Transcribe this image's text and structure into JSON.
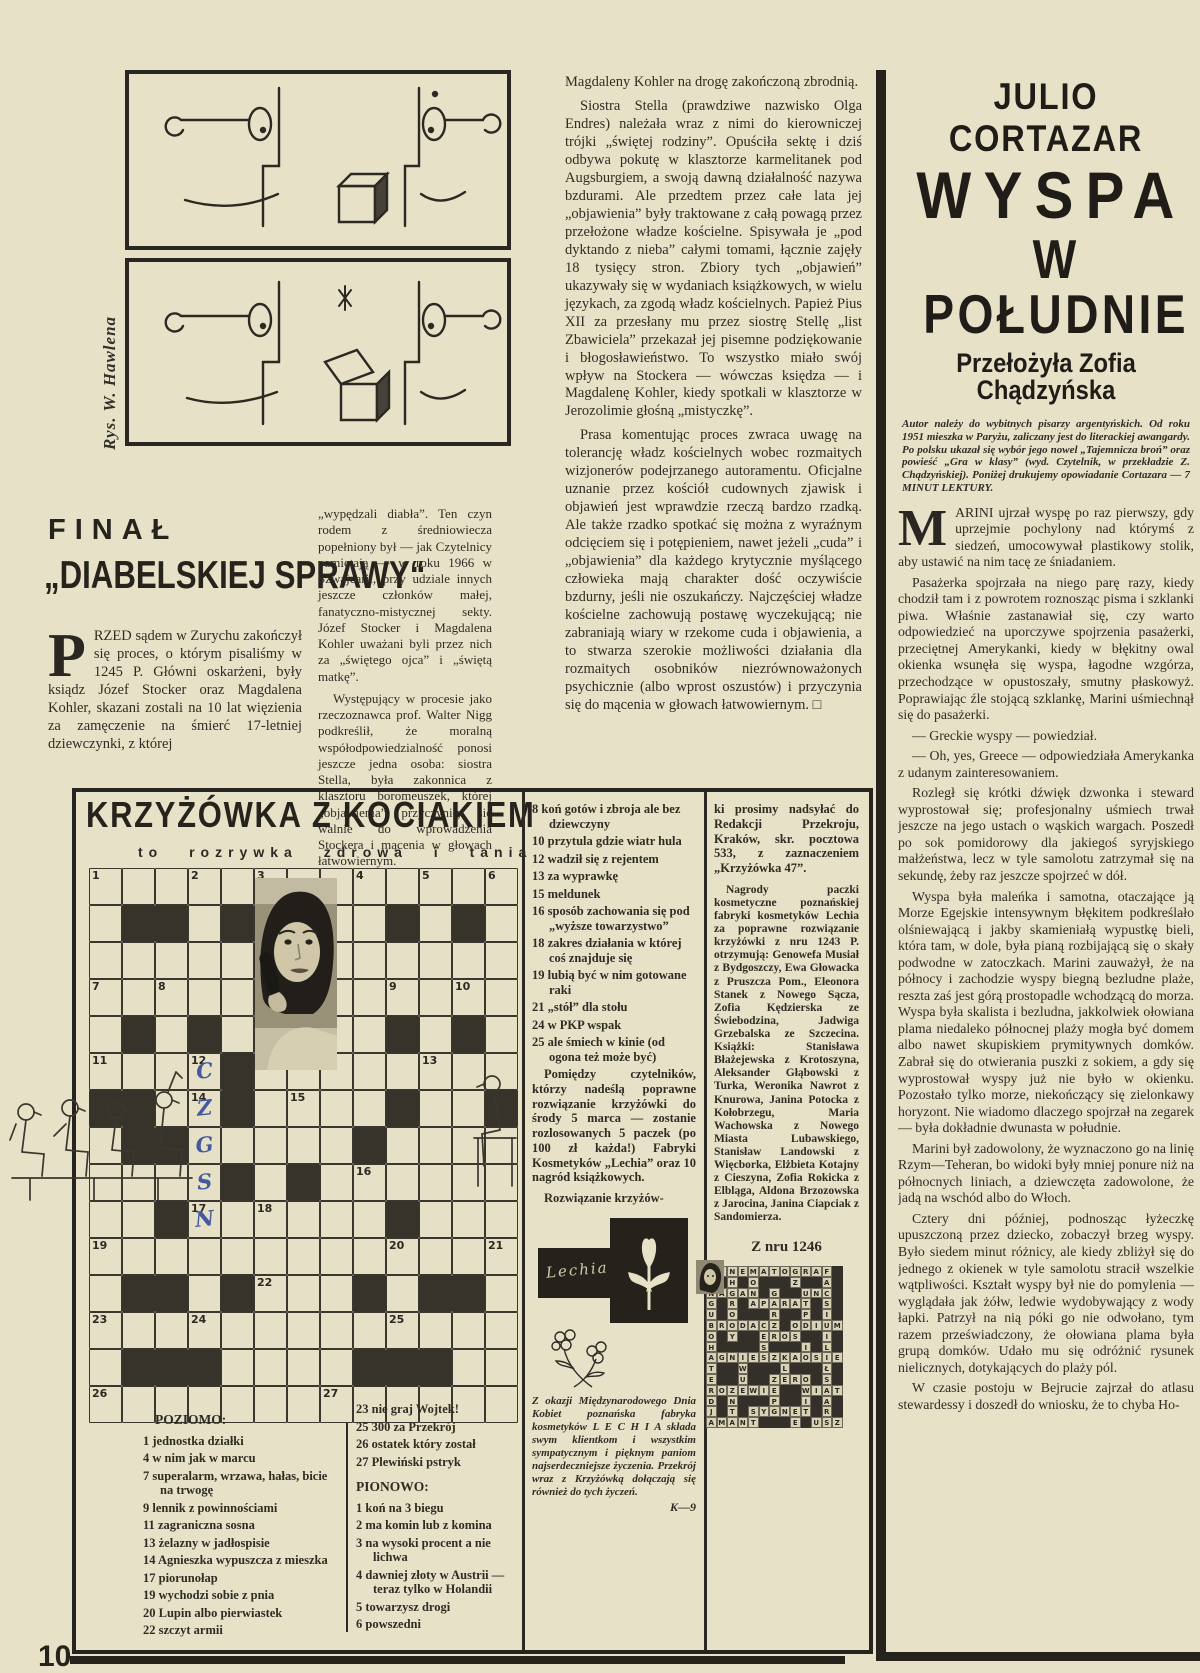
{
  "page": {
    "number": "10"
  },
  "cartoon": {
    "credit": "Rys. W. Hawlena"
  },
  "midcol": {
    "paragraphs": [
      "Magdaleny Kohler na drogę zakończoną zbrodnią.",
      "Siostra Stella (prawdziwe nazwisko Olga Endres) należała wraz z nimi do kierowniczej trójki „świętej rodziny”. Opuściła sektę i dziś odbywa pokutę w klasztorze karmelitanek pod Augsburgiem, a swoją dawną działalność nazywa bzdurami. Ale przedtem przez całe lata jej „objawienia” były traktowane z całą powagą przez przełożone władze kościelne. Spisywała je „pod dyktando z nieba” całymi tomami, łącznie zajęły 18 tysięcy stron. Zbiory tych „objawień” ukazywały się w wydaniach książkowych, w wielu językach, za zgodą władz kościelnych. Papież Pius XII za przesłany mu przez siostrę Stellę „list Zbawiciela” przekazał jej pisemne podziękowanie i błogosławieństwo. To wszystko miało swój wpływ na Stockera — wówczas księdza — i Magdalenę Kohler, kiedy spotkali w klasztorze w Jerozolimie głośną „mistyczkę”.",
      "Prasa komentując proces zwraca uwagę na tolerancję władz kościelnych wobec rozmaitych wizjonerów podejrzanego autoramentu. Oficjalne uznanie przez kościół cudownych zjawisk i objawień jest wprawdzie rzeczą bardzo rzadką. Ale także rzadko spotkać się można z wyraźnym odcięciem się i potępieniem, nawet jeżeli „cuda” i „objawienia” dla każdego krytycznie myślącego człowieka mają charakter dość oczywiście bzdurny, jeśli nie oszukańczy. Najczęściej władze kościelne zachowują postawę wyczekującą; nie zabraniają wiary w rzekome cuda i objawienia, a to stwarza szerokie możliwości działania dla rozmaitych osobników niezrównoważonych psychicznie (albo wprost oszustów) i przyczynia się do mącenia w głowach łatwowiernym. □"
    ]
  },
  "finale": {
    "kicker": "FINAŁ",
    "title": "„DIABELSKIEJ SPRAWY“",
    "dropcap": "P",
    "col1_rest": "RZED sądem w Zurychu zakończył się proces, o którym pisaliśmy w 1245 P. Główni oskarżeni, były ksiądz Józef Stocker oraz Magdalena Kohler, skazani zostali na 10 lat więzienia za zamęczenie na śmierć 17-letniej dziewczynki, z której",
    "col2_paragraphs": [
      "„wypędzali diabła”. Ten czyn rodem z średniowiecza popełniony był — jak Czytelnicy pamiętają — w roku 1966 w Szwajcarii, przy udziale innych jeszcze członków małej, fanatyczno-mistycznej sekty. Józef Stocker i Magdalena Kohler uważani byli przez nich za „świętego ojca” i „świętą matkę”.",
      "Występujący w procesie jako rzeczoznawca prof. Walter Nigg podkreślił, że moralną współodpowiedzialność ponosi jeszcze jedna osoba: siostra Stella, była zakonnica z klasztoru boromeuszek, której „objawienia” przyczyniły się walnie do wprowadzenia Stockera i mącenia w głowach łatwowiernym."
    ]
  },
  "cortazar": {
    "author": "JULIO CORTAZAR",
    "title_line1": "WYSPA",
    "title_line2": "W POŁUDNIE",
    "translator": "Przełożyła Zofia Chądzyńska",
    "intro": "Autor należy do wybitnych pisarzy argentyńskich. Od roku 1951 mieszka w Paryżu, zaliczany jest do literackiej awangardy. Po polsku ukazał się wybór jego nowel „Tajemnicza broń” oraz powieść „Gra w klasy” (wyd. Czytelnik, w przekładzie Z. Chądzyńskiej). Poniżej drukujemy opowiadanie Cortazara — 7 MINUT LEKTURY.",
    "dropcap": "M",
    "first_paragraph": "ARINI ujrzał wyspę po raz pierwszy, gdy uprzejmie pochylony nad którymś z siedzeń, umocowywał plastikowy stolik, aby ustawić na nim tacę ze śniadaniem.",
    "paragraphs": [
      "Pasażerka spojrzała na niego parę razy, kiedy chodził tam i z powrotem roznosząc pisma i szklanki piwa. Właśnie zastanawiał się, czy warto odpowiedzieć na uporczywe spojrzenia pasażerki, przeciętnej Amerykanki, kiedy w błękitny owal okienka wsunęła się wyspa, łagodne wzgórza, przechodzące w opustoszały, smutny płaskowyż. Poprawiając źle stojącą szklankę, Marini uśmiechnął się do pasażerki.",
      "— Greckie wyspy — powiedział.",
      "— Oh, yes, Greece — odpowiedziała Amerykanka z udanym zainteresowaniem.",
      "Rozległ się krótki dźwięk dzwonka i steward wyprostował się; profesjonalny uśmiech trwał jeszcze na jego ustach o wąskich wargach. Poszedł po sok pomidorowy dla jakiegoś syryjskiego małżeństwa, lecz w tyle samolotu zatrzymał się na sekundę, żeby raz jeszcze spojrzeć w dół.",
      "Wyspa była maleńka i samotna, otaczające ją Morze Egejskie intensywnym błękitem podkreślało olśniewającą i jakby skamieniałą wypustkę bieli, która tam, w dole, była pianą rozbijającą się o skały podwodne w zatoczkach. Marini zauważył, że na północy i zachodzie wyspy biegną bezludne plaże, reszta zaś jest górą prostopadle wchodzącą do morza. Wyspa była skalista i bezludna, jakkolwiek ołowiana plama niedaleko północnej plaży mogła być domem albo nawet skupiskiem prymitywnych domków. Zabrał się do otwierania puszki z sokiem, a gdy się wyprostował wyspy już nie było w okienku. Pozostało tylko morze, niekończący się zielonkawy horyzont. Nie wiadomo dlaczego spojrzał na zegarek — była dokładnie dwunasta w południe.",
      "Marini był zadowolony, że wyznaczono go na linię Rzym—Teheran, bo widoki były mniej ponure niż na północnych liniach, a dziewczęta zadowolone, że jadą na wschód albo do Włoch.",
      "Cztery dni później, podnosząc łyżeczkę upuszczoną przez dziecko, zobaczył brzeg wyspy. Było siedem minut różnicy, ale kiedy zbliżył się do jednego z okienek w tyle samolotu stracił wszelkie wątpliwości. Kształt wyspy był nie do pomylenia — wyglądała jak żółw, ledwie wydobywający z wody łapki. Patrzył na nią póki go nie odwołano, tym razem przeświadczony, że ołowiana plama była grupą domków. Udało mu się odróżnić rysunek nielicznych, dotykających do plaży pól.",
      "W czasie postoju w Bejrucie zajrzał do atlasu stewardessy i doszedł do wniosku, że to chyba Ho-"
    ]
  },
  "crossword": {
    "title": "KRZYŻÓWKA Z KOCIAKIEM",
    "subtitle": "to rozrywka zdrowa i tania",
    "grid": {
      "rows": [
        ".............",
        ".##.#....#.#.",
        ".....#.......",
        ".............",
        ".#.#.....#.#.",
        "....#........",
        "##..#....#..#",
        ".##.....#....",
        "....#.#......",
        "..#......#...",
        ".............",
        ".##.#...#.##.",
        ".............",
        ".###....###..",
        "............."
      ],
      "numbers": {
        "1-1": "1",
        "1-4": "2",
        "1-6": "3",
        "1-9": "4",
        "1-11": "5",
        "1-13": "6",
        "4-1": "7",
        "4-3": "8",
        "4-10": "9",
        "4-12": "10",
        "6-1": "11",
        "6-4": "12",
        "6-11": "13",
        "7-4": "14",
        "7-7": "15",
        "9-9": "16",
        "10-4": "17",
        "10-6": "18",
        "11-1": "19",
        "11-10": "20",
        "11-13": "21",
        "12-6": "22",
        "13-1": "23",
        "13-4": "24",
        "13-10": "25",
        "15-1": "26",
        "15-8": "27"
      },
      "handwritten": {
        "6-4": "C",
        "7-4": "Z",
        "8-4": "G",
        "9-4": "S",
        "10-4": "N"
      },
      "handwriting_color": "#44599e"
    },
    "clues_middle": [
      {
        "n": "8",
        "t": "koń gotów i zbroja ale bez dziewczyny"
      },
      {
        "n": "10",
        "t": "przytula gdzie wiatr hula"
      },
      {
        "n": "12",
        "t": "wadził się z rejentem"
      },
      {
        "n": "13",
        "t": "za wyprawkę"
      },
      {
        "n": "15",
        "t": "meldunek"
      },
      {
        "n": "16",
        "t": "sposób zachowania się pod „wyższe towarzystwo”"
      },
      {
        "n": "18",
        "t": "zakres działania w której coś znajduje się"
      },
      {
        "n": "19",
        "t": "lubią być w nim gotowane raki"
      },
      {
        "n": "21",
        "t": "„stół” dla stołu"
      },
      {
        "n": "24",
        "t": "w PKP wspak"
      },
      {
        "n": "25",
        "t": "ale śmiech w kinie (od ogona też może być)"
      }
    ],
    "prize_paragraphs": [
      "Pomiędzy czytelników, którzy nadeślą poprawne rozwiązanie krzyżówki do środy 5 marca — zostanie rozlosowanych 5 paczek (po 100 zł każda!) Fabryki Kosmetyków „Lechia” oraz 10 nagród książkowych.",
      "Rozwiązanie krzyżów-"
    ],
    "mailing_paragraph": "ki prosimy nadsyłać do Redakcji Przekroju, Kraków, skr. pocztowa 533, z zaznaczeniem „Krzyżówka 47”.",
    "winners_paragraph": "Nagrody paczki kosmetyczne poznańskiej fabryki kosmetyków Lechia za poprawne rozwiązanie krzyżówki z nru 1243 P. otrzymują: Genowefa Musiał z Bydgoszczy, Ewa Głowacka z Pruszcza Pom., Eleonora Stanek z Nowego Sącza, Zofia Kędzierska ze Świebodzina, Jadwiga Grzebalska ze Szczecina. Książki: Stanisława Błażejewska z Krotoszyna, Aleksander Głąbowski z Turka, Weronika Nawrot z Knurowa, Janina Potocka z Kołobrzegu, Maria Wachowska z Nowego Miasta Lubawskiego, Stanisław Landowski z Więcborka, Elżbieta Kotajny z Cieszyna, Zofia Rokicka z Elbląga, Aldona Brzozowska z Jarocina, Janina Ciapciak z Sandomierza.",
    "from_issue": "Z nru 1246",
    "poziomo_label": "POZIOMO:",
    "clues_poziomo": [
      {
        "n": "1",
        "t": "jednostka działki"
      },
      {
        "n": "4",
        "t": "w nim jak w marcu"
      },
      {
        "n": "7",
        "t": "superalarm, wrzawa, hałas, bicie na trwogę"
      },
      {
        "n": "9",
        "t": "lennik z powinnościami"
      },
      {
        "n": "11",
        "t": "zagraniczna sosna"
      },
      {
        "n": "13",
        "t": "żelazny w jadłospisie"
      },
      {
        "n": "14",
        "t": "Agnieszka wypuszcza z mieszka"
      },
      {
        "n": "17",
        "t": "piorunołap"
      },
      {
        "n": "19",
        "t": "wychodzi sobie z pnia"
      },
      {
        "n": "20",
        "t": "Lupin albo pierwiastek"
      },
      {
        "n": "22",
        "t": "szczyt armii"
      }
    ],
    "clues_col2": [
      {
        "n": "23",
        "t": "nie graj Wojtek!"
      },
      {
        "n": "25",
        "t": "300 za Przekrój"
      },
      {
        "n": "26",
        "t": "ostatek który został"
      },
      {
        "n": "27",
        "t": "Plewiński pstryk"
      }
    ],
    "pionowo_label": "PIONOWO:",
    "clues_pionowo": [
      {
        "n": "1",
        "t": "koń na 3 biegu"
      },
      {
        "n": "2",
        "t": "ma komin lub z komina"
      },
      {
        "n": "3",
        "t": "na wysoki procent a nie lichwa"
      },
      {
        "n": "4",
        "t": "dawniej złoty w Austrii — teraz tylko w Holandii"
      },
      {
        "n": "5",
        "t": "towarzysz drogi"
      },
      {
        "n": "6",
        "t": "powszedni"
      }
    ],
    "lechia_logo_text": "Lechia",
    "lechia_note": "Z okazji Międzynarodowego Dnia Kobiet poznańska fabryka kosmetyków L E C H I A składa swym klientkom i wszystkim sympatycznym i pięknym paniom najserdeczniejsze życzenia. Przekrój wraz z Krzyżówką dołączają się również do tych życzeń.",
    "lechia_sig": "K—9",
    "solution_grid": {
      "rows": [
        "KINEMATOGRAF.",
        "A.H.O...Z..A.",
        "NAGAN.G..UNC.",
        "G.R.APARAT.S.",
        "U.O...R..P.I.",
        "BRODACZ.ODIUM",
        "O.Y..EROS..I.",
        "H....S...I.L.",
        "AGNIESZKAOSIE",
        "T..W...L...Ł.",
        "E..U..ZERO.S.",
        "ROZEWIE..WIAT",
        "D.N...P..I.A.",
        "J.T.SYGNET.R.",
        "AMANT...E.USZ"
      ]
    }
  }
}
